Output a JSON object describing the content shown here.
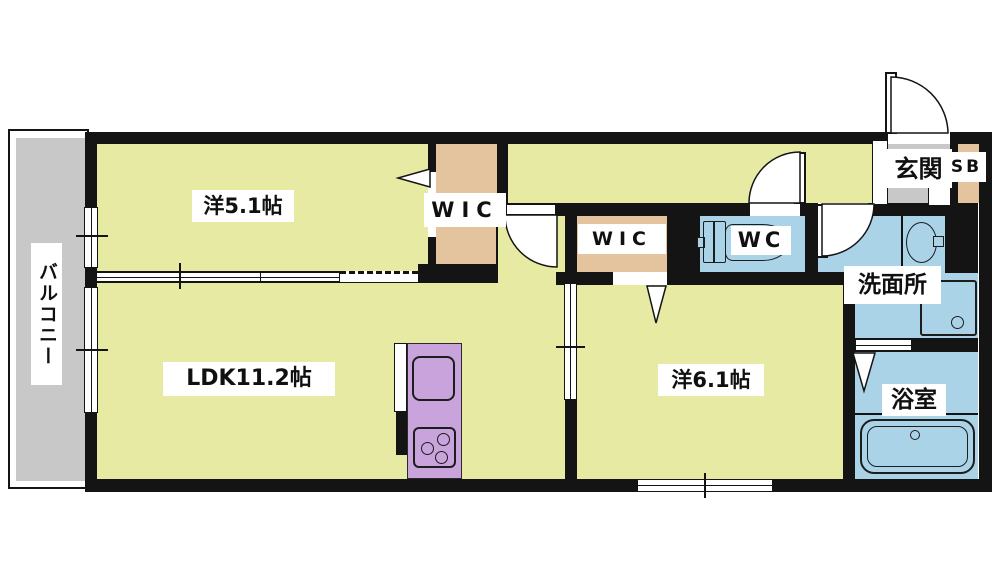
{
  "document": {
    "kind": "apartment-floor-plan"
  },
  "colors": {
    "wall": "#141414",
    "room_floor_yellow": "#e7eaa2",
    "closet_tan": "#e4c49e",
    "wet_area_blue": "#abd3e8",
    "balcony_gray": "#c8c8c8",
    "entrance_gray": "#c8c8c8",
    "kitchen_purple": "#c8a3dc",
    "label_background": "#ffffff",
    "label_text": "#101010"
  },
  "rooms": {
    "balcony": {
      "label": "バルコニー"
    },
    "bedroom1": {
      "label": "洋5.1帖"
    },
    "wic1": {
      "label": "WIC"
    },
    "entrance": {
      "label": "玄関"
    },
    "shoe_box": {
      "label": "SB"
    },
    "wic2": {
      "label": "WIC"
    },
    "wc": {
      "label": "WC"
    },
    "washroom": {
      "label": "洗面所"
    },
    "bathroom": {
      "label": "浴室"
    },
    "ldk": {
      "label": "LDK11.2帖"
    },
    "bedroom2": {
      "label": "洋6.1帖"
    }
  }
}
